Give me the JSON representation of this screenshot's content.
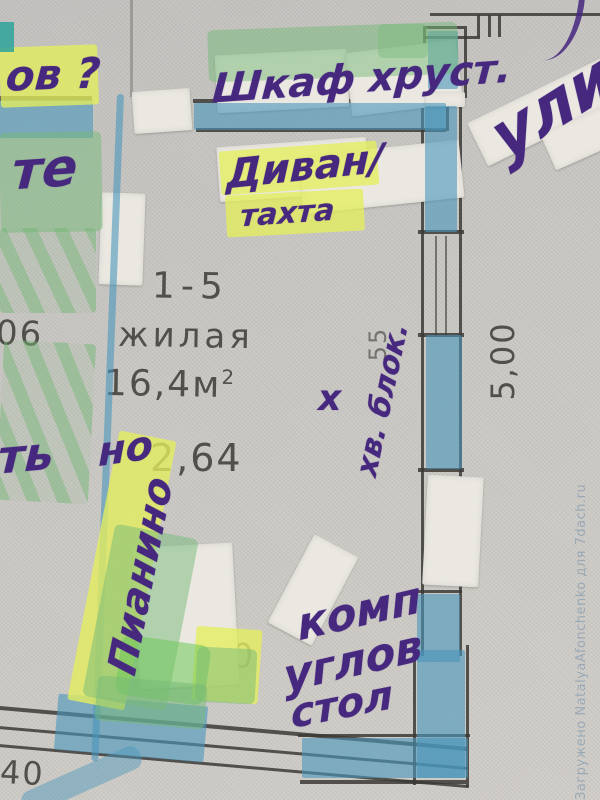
{
  "watermark": {
    "text": "Загружено NatalyaAfonchenko для 7dach.ru"
  },
  "printed": {
    "dim_left": "06",
    "room_id": "1-5",
    "room_label": "жилая",
    "area": "16,4м",
    "area_sup": "2",
    "height": "2,64",
    "dim_right": "5,00",
    "dim_55": "55",
    "dim_40": "40",
    "dim_30": "30"
  },
  "handwritten": {
    "top_left": "ов ?",
    "left_upper": "те",
    "wardrobe": "Шкаф хруст.",
    "sofa": "Диван/",
    "sofa2": "тахта",
    "street": "ули",
    "cross": "х",
    "hv_block": "хв. блок.",
    "left_mid": "ть",
    "height_overwrite": "но",
    "piano": "Пианино",
    "desk1": "комп",
    "desk2": "углов",
    "desk3": "стол"
  },
  "palette": {
    "ink_purple": "#46287f",
    "marker_blue": "#4a96ba",
    "highlight_green": "#76b978",
    "highlight_yellow": "#e4ee5c",
    "paper": "#c9c7c3",
    "print_ink": "#45433e",
    "watermark_color": "#97a8b6"
  }
}
